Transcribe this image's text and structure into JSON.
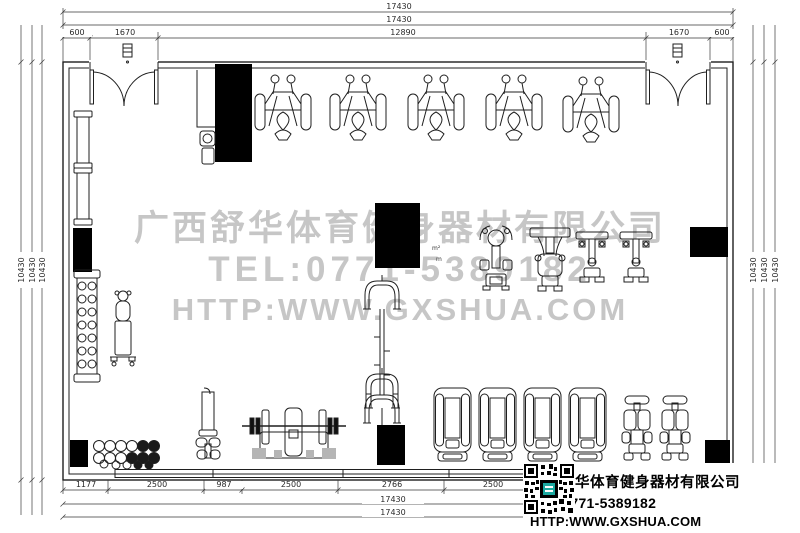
{
  "watermark": {
    "line1": "广西舒华体育健身器材有限公司",
    "line2": "TEL:0771-5389182",
    "line3": "HTTP:WWW.GXSHUA.COM"
  },
  "info_box": {
    "company": "广西舒华体育健身器材有限公司",
    "tel": "TEL:0771-5389182",
    "web": "HTTP:WWW.GXSHUA.COM",
    "qr_icon": "qr-code"
  },
  "dimensions": {
    "top": {
      "total_outer": "17430",
      "total_inner": "17430",
      "segments": [
        "600",
        "1670",
        "12890",
        "1670",
        "600"
      ]
    },
    "bottom": {
      "segments": [
        "1177",
        "2500",
        "987",
        "2500",
        "2766",
        "2500"
      ],
      "total_inner": "17430",
      "total_outer": "17430"
    },
    "left": [
      "10430",
      "10430",
      "10430"
    ],
    "right": [
      "10430",
      "10430",
      "10430"
    ],
    "area_note_sup": "m²",
    "area_note": "m"
  },
  "colors": {
    "line": "#1f1f1f",
    "watermark_gray": "#c6c6c6",
    "column_fill": "#000000",
    "qr_accent": "#1ba8a0"
  },
  "equipment_icons": [
    "entrance-double-door",
    "door-tag",
    "weight-stack-machine",
    "lat-pulldown-machine",
    "shoulder-press-machine",
    "cable-crossover-station",
    "bench-press-station",
    "vertical-rack-machine",
    "dumbbell-rack",
    "wall-bars",
    "medicine-ball-rack",
    "water-cooler",
    "treadmill",
    "exercise-bike",
    "structural-column",
    "window-band",
    "qr-code"
  ]
}
